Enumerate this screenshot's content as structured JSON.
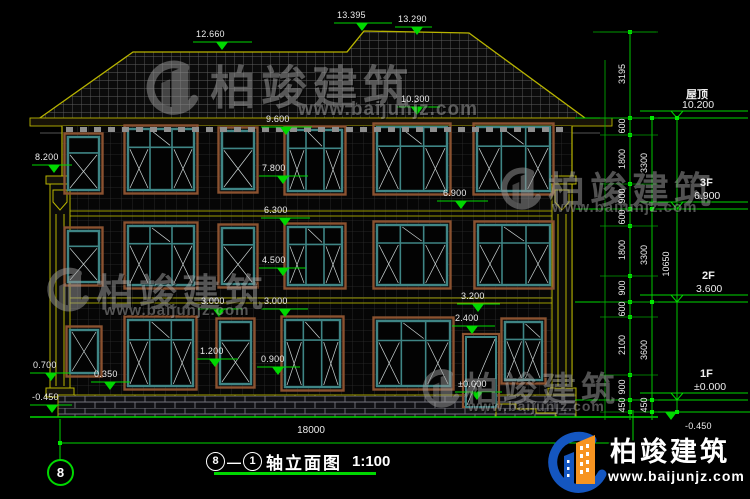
{
  "watermark": {
    "brand": "柏竣建筑",
    "url": "www.baijunjz.com"
  },
  "logo": {
    "brand": "柏竣建筑",
    "url": "www.baijunjz.com"
  },
  "title": {
    "axis_a": "8",
    "axis_b": "1",
    "text": "轴立面图",
    "scale": "1:100"
  },
  "axis_bubble": "8",
  "ground_dim": "18000",
  "floors": [
    {
      "name": "屋顶",
      "elev": "10.200"
    },
    {
      "name": "3F",
      "elev": "6.900"
    },
    {
      "name": "2F",
      "elev": "3.600"
    },
    {
      "name": "1F",
      "elev": "±0.000"
    }
  ],
  "elev_markers": [
    "12.660",
    "13.395",
    "13.290",
    "10.300",
    "9.600",
    "7.800",
    "6.900",
    "6.300",
    "4.500",
    "3.000",
    "3.000",
    "3.200",
    "2.400",
    "1.200",
    "0.900",
    "±0.000",
    "8.200",
    "0.700",
    "0.350",
    "-0.450",
    "-0.450"
  ],
  "dim_cols": {
    "col1": [
      "3195",
      "600",
      "1800",
      "900",
      "600",
      "1800",
      "900",
      "600",
      "2100",
      "900",
      "450"
    ],
    "col2": [
      "3300",
      "3300",
      "3600",
      "450"
    ],
    "col3": [
      "10650"
    ]
  },
  "colors": {
    "cad_green": "#00d800",
    "outline_yellow": "#b8b400",
    "window_teal": "#3f8585",
    "trim_brown": "#8a5230",
    "logo_blue": "#1456c0",
    "logo_orange": "#f79420"
  }
}
